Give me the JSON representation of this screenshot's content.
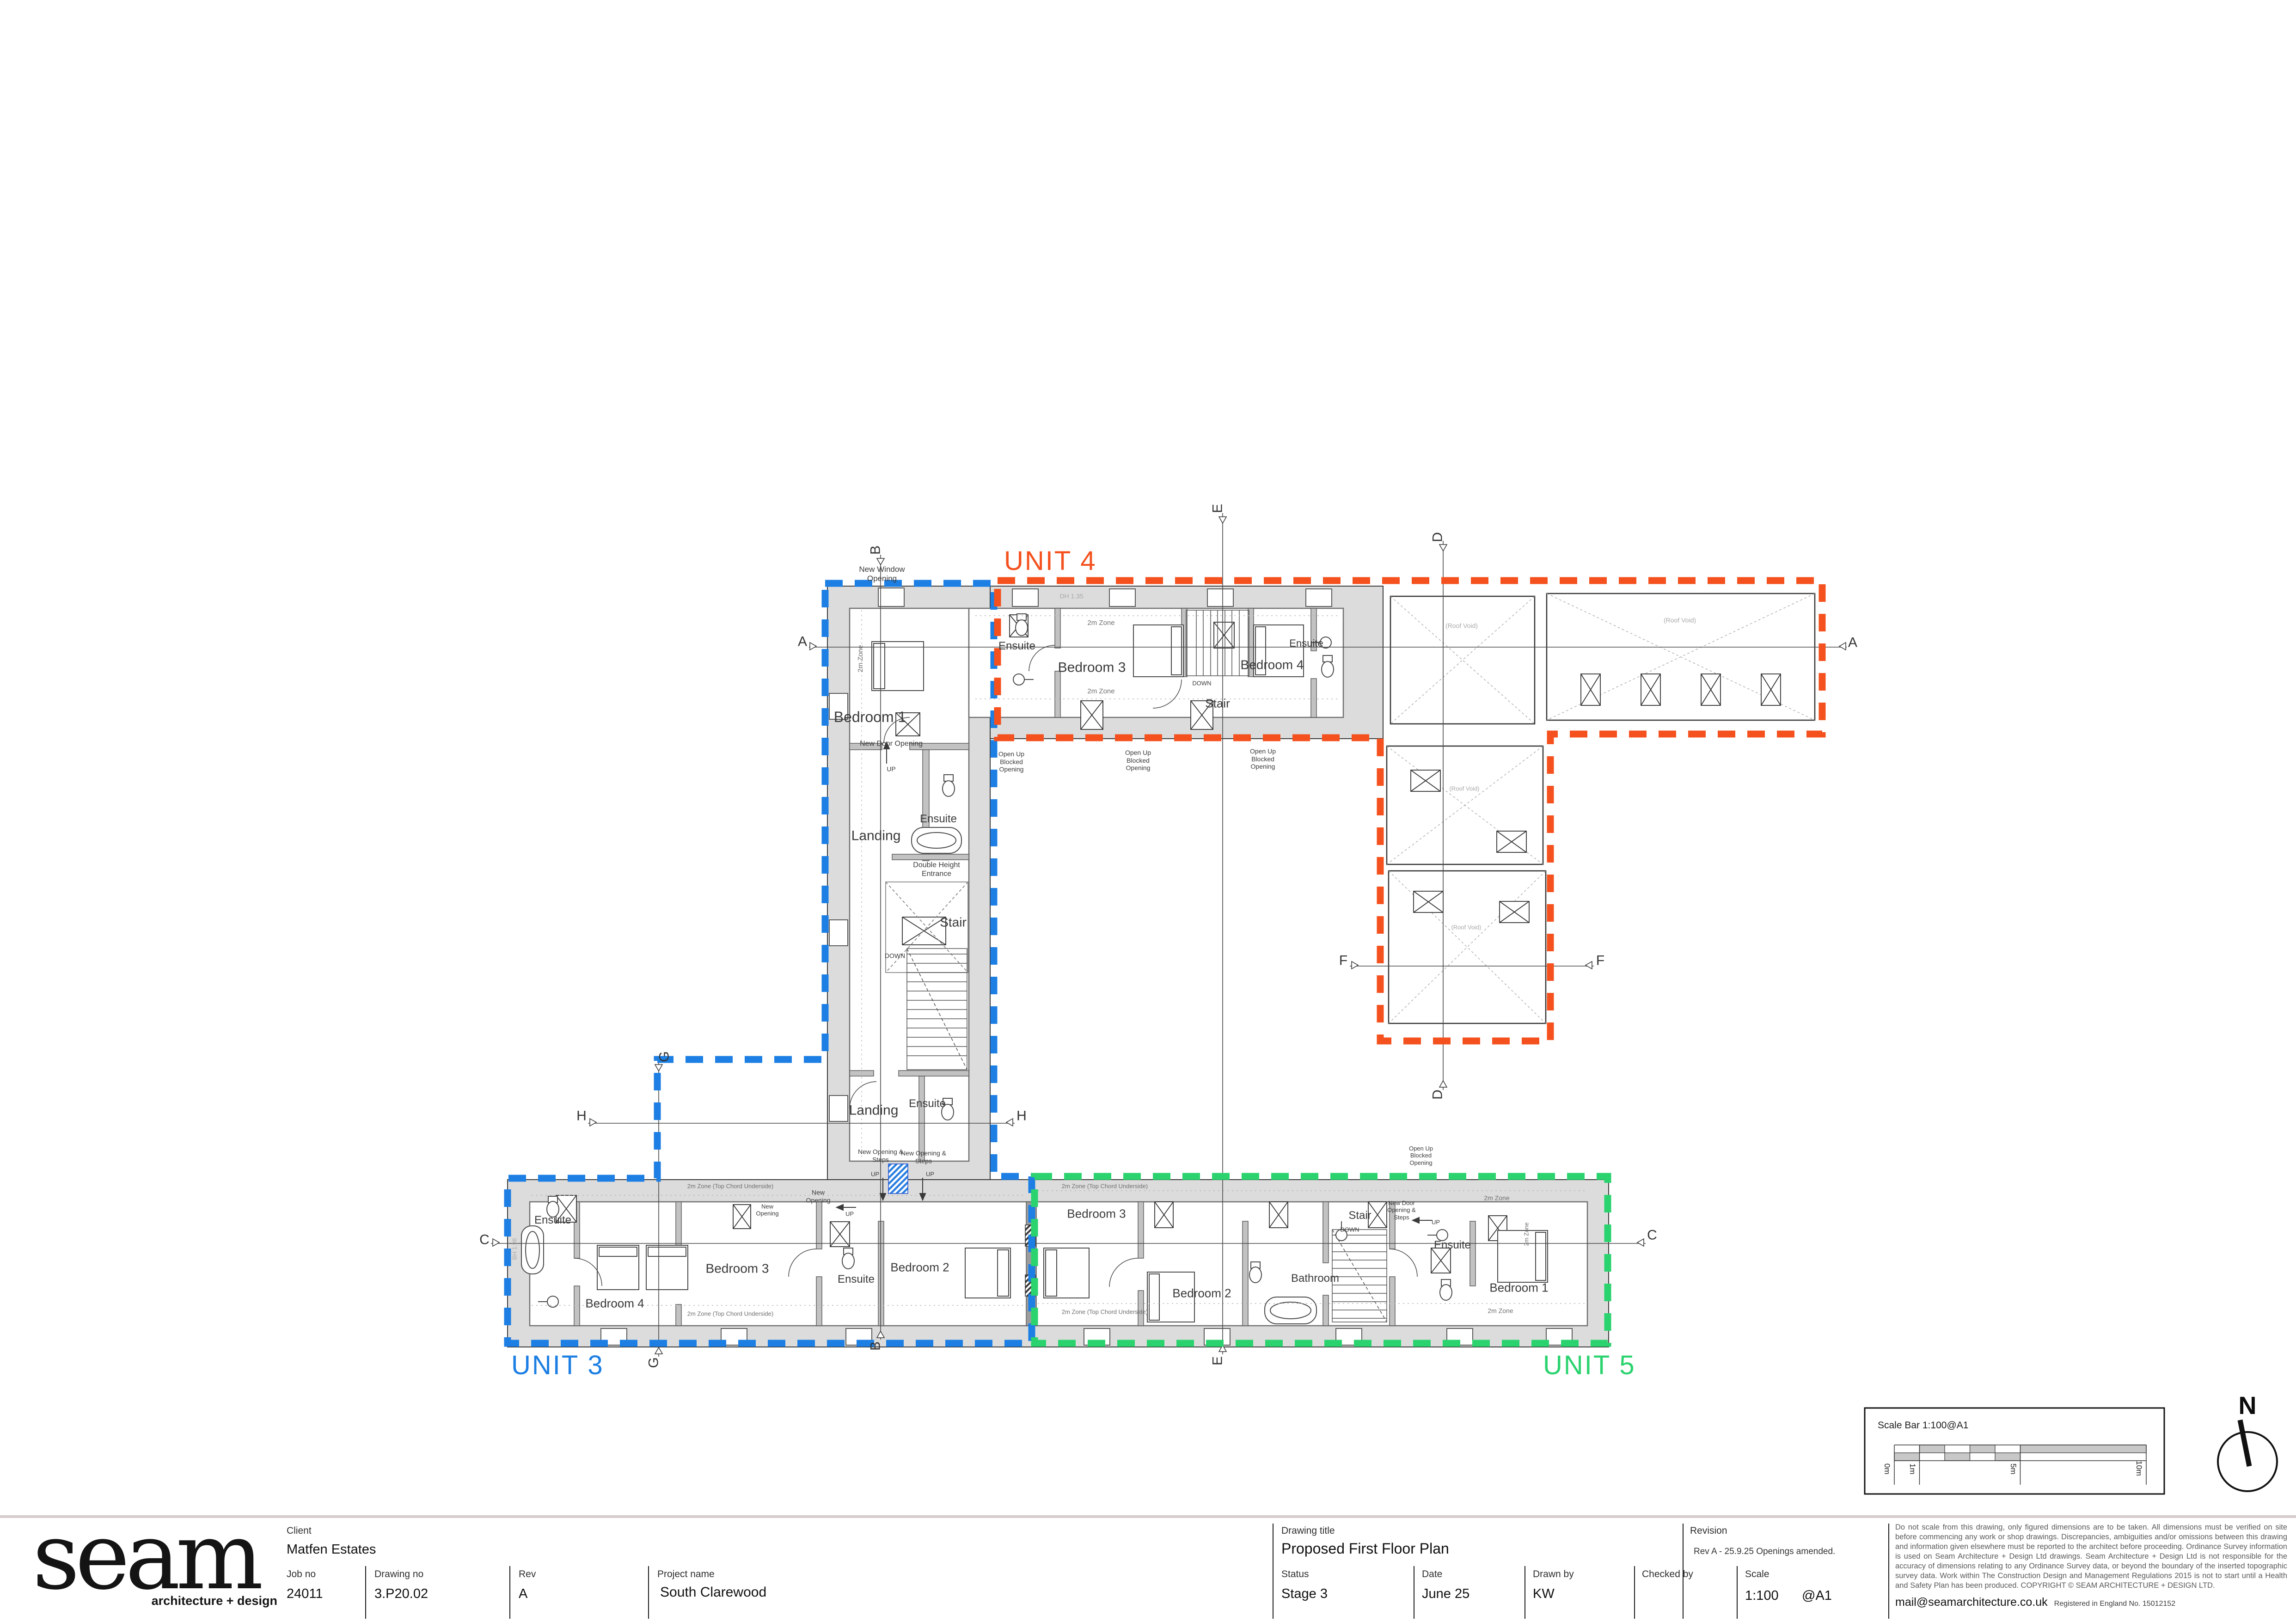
{
  "units": {
    "unit3": {
      "label": "UNIT 3",
      "color": "#1d7fe3"
    },
    "unit4": {
      "label": "UNIT 4",
      "color": "#f4511e"
    },
    "unit5": {
      "label": "UNIT 5",
      "color": "#2bd36f"
    }
  },
  "rooms": {
    "bedroom1": "Bedroom 1",
    "bedroom2": "Bedroom 2",
    "bedroom3": "Bedroom 3",
    "bedroom4": "Bedroom 4",
    "landing": "Landing",
    "ensuite": "Ensuite",
    "stair": "Stair",
    "bathroom": "Bathroom"
  },
  "annotations": {
    "up": "UP",
    "down": "DOWN",
    "two_m_zone": "2m Zone",
    "two_m_zone_chord": "2m Zone (Top Chord Underside)",
    "roof_void": "(Roof Void)",
    "new_window_opening": "New Window Opening",
    "new_door_opening": "New Door Opening",
    "new_door_opening_steps": "New Door Opening & Steps",
    "new_opening_steps": "New Opening & Steps",
    "new_opening": "New Opening",
    "open_up_blocked": "Open Up Blocked Opening",
    "double_height_entrance": "Double Height Entrance",
    "dh_135": "DH 1.35",
    "bh_198": "BH 1.98"
  },
  "section_markers": {
    "a": "A",
    "b": "B",
    "c": "C",
    "d": "D",
    "e": "E",
    "f": "F",
    "g": "G",
    "h": "H"
  },
  "title_block": {
    "client_label": "Client",
    "client": "Matfen Estates",
    "job_no_label": "Job no",
    "job_no": "24011",
    "drawing_no_label": "Drawing no",
    "drawing_no": "3.P20.02",
    "rev_label": "Rev",
    "rev": "A",
    "project_name_label": "Project name",
    "project_name": "South Clarewood",
    "drawing_title_label": "Drawing title",
    "drawing_title": "Proposed First Floor Plan",
    "status_label": "Status",
    "status": "Stage 3",
    "date_label": "Date",
    "date": "June 25",
    "drawn_by_label": "Drawn by",
    "drawn_by": "KW",
    "checked_by_label": "Checked by",
    "checked_by": "",
    "scale_label": "Scale",
    "scale": "1:100",
    "scale_suffix": "@A1",
    "revision_label": "Revision",
    "revision_note": "Rev A - 25.9.25 Openings amended.",
    "disclaimer": "Do not scale from this drawing, only figured dimensions are to be taken. All dimensions must be verified on site before commencing any work or shop drawings. Discrepancies,  ambiguities and/or omissions between this drawing and information given elsewhere must be reported to the architect before proceeding. Ordinance Survey information is used on Seam Architecture + Design Ltd drawings. Seam Architecture + Design Ltd is not responsible for the accuracy of dimensions relating to any Ordinance Survey data, or beyond the boundary of the inserted topographic survey data. Work within The Construction Design and Management Regulations 2015 is not to start until a Health and Safety Plan has been produced. COPYRIGHT © SEAM ARCHITECTURE + DESIGN LTD.",
    "email": "mail@seamarchitecture.co.uk",
    "registration": "Registered in England No. 15012152"
  },
  "logo": {
    "wordmark": "seam",
    "tagline": "architecture + design"
  },
  "scale_bar": {
    "title": "Scale Bar 1:100@A1",
    "tick0": "0m",
    "tick1": "1m",
    "tick5": "5m",
    "tick10": "10m"
  },
  "north_arrow": {
    "label": "N"
  }
}
